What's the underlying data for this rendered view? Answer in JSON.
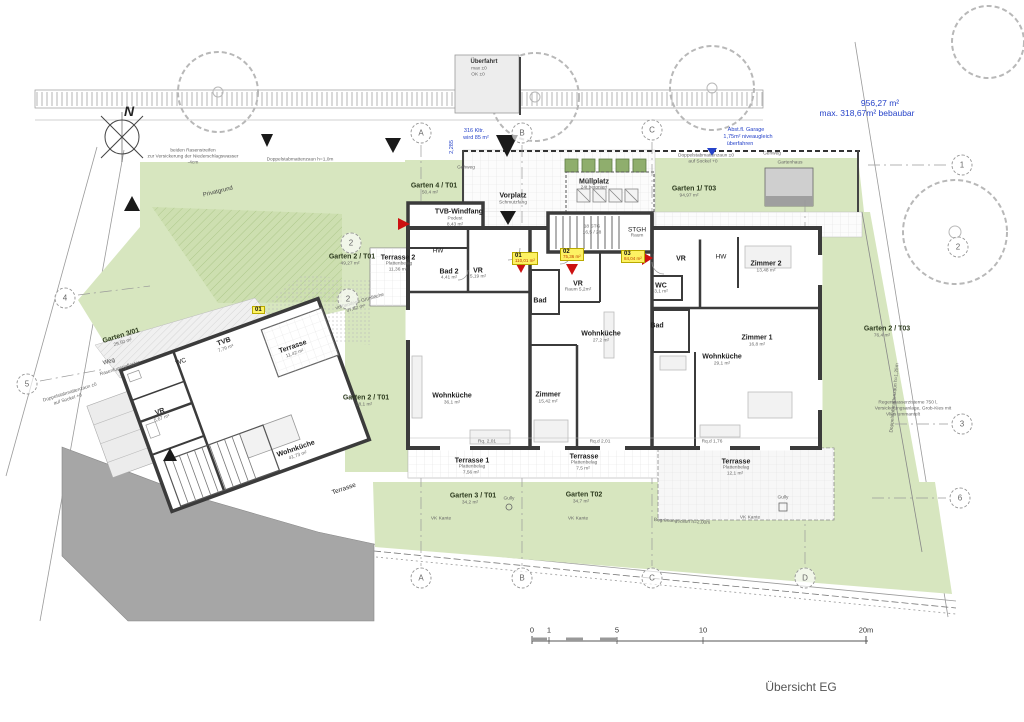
{
  "title": {
    "text": "Übersicht EG"
  },
  "colors": {
    "garden_green": "#d7e6bf",
    "hatch_green": "#aec88b",
    "street_gray": "#a6a6a6",
    "wall_dark": "#3b3b3b",
    "annotation_blue": "#2643c9",
    "unit_badge_yellow": "#fdf263",
    "entrance_red": "#cc1111"
  },
  "scalebar": {
    "unit": "m",
    "ticks": [
      {
        "t": "0",
        "x": 532
      },
      {
        "t": "1",
        "x": 549
      },
      {
        "t": "5",
        "x": 617
      },
      {
        "t": "10",
        "x": 703
      },
      {
        "t": "20m",
        "x": 866
      }
    ]
  },
  "badges": [
    {
      "no": "01",
      "area": "110,01 m²",
      "x": 512,
      "y": 252
    },
    {
      "no": "02",
      "area": "75,36 m²",
      "x": 560,
      "y": 248
    },
    {
      "no": "03",
      "area": "84,04 m²",
      "x": 621,
      "y": 250
    },
    {
      "no": "01",
      "area": "",
      "x": 252,
      "y": 306
    }
  ],
  "bubbles": [
    {
      "t": "A",
      "x": 421,
      "y": 133
    },
    {
      "t": "B",
      "x": 522,
      "y": 133
    },
    {
      "t": "C",
      "x": 652,
      "y": 130
    },
    {
      "t": "1",
      "x": 962,
      "y": 165
    },
    {
      "t": "2",
      "x": 958,
      "y": 247
    },
    {
      "t": "3",
      "x": 962,
      "y": 424
    },
    {
      "t": "6",
      "x": 960,
      "y": 498
    },
    {
      "t": "4",
      "x": 65,
      "y": 298
    },
    {
      "t": "5",
      "x": 27,
      "y": 384
    },
    {
      "t": "A",
      "x": 421,
      "y": 578
    },
    {
      "t": "B",
      "x": 522,
      "y": 578
    },
    {
      "t": "C",
      "x": 652,
      "y": 578
    },
    {
      "t": "D",
      "x": 805,
      "y": 578
    },
    {
      "t": "2",
      "x": 351,
      "y": 243
    },
    {
      "t": "2",
      "x": 348,
      "y": 299
    }
  ],
  "labels": [
    {
      "t": "N",
      "x": 129,
      "y": 111,
      "c": "north"
    },
    {
      "t": "956,27 m²",
      "x": 880,
      "y": 103,
      "c": "bn"
    },
    {
      "t": "max. 318,67m² bebaubar",
      "x": 867,
      "y": 113,
      "c": "bn"
    },
    {
      "t": "Überfahrt",
      "x": 484,
      "y": 62,
      "c": "tb"
    },
    {
      "t": "max ±0",
      "x": 479,
      "y": 69,
      "c": "m"
    },
    {
      "t": "OK ±0",
      "x": 478,
      "y": 75,
      "c": "m"
    },
    {
      "t": "316 Kltr.",
      "x": 474,
      "y": 131,
      "c": "bt"
    },
    {
      "t": "wird 85 m²",
      "x": 476,
      "y": 138,
      "c": "bt"
    },
    {
      "t": "2,285",
      "x": 452,
      "y": 147,
      "c": "bt",
      "r": -90
    },
    {
      "t": "Abst.fl. Garage",
      "x": 746,
      "y": 130,
      "c": "bt"
    },
    {
      "t": "1,75m² niveaugleich",
      "x": 748,
      "y": 137,
      "c": "bt"
    },
    {
      "t": "überfahren",
      "x": 740,
      "y": 144,
      "c": "bt"
    },
    {
      "t": "beiden Rasenstreifen",
      "x": 193,
      "y": 151,
      "c": "m"
    },
    {
      "t": "zur Versickerung der Niederschlagswasser",
      "x": 193,
      "y": 157,
      "c": "m"
    },
    {
      "t": "-4cm",
      "x": 193,
      "y": 163,
      "c": "m"
    },
    {
      "t": "Privatgrund",
      "x": 218,
      "y": 192,
      "c": "t",
      "r": -14
    },
    {
      "t": "Doppelstabmattenzaun h=1,0m",
      "x": 300,
      "y": 160,
      "c": "m"
    },
    {
      "t": "Gehweg",
      "x": 466,
      "y": 168,
      "c": "m"
    },
    {
      "t": "Garten 4 / T01",
      "x": 434,
      "y": 186,
      "c": "g"
    },
    {
      "t": "50,4 m²",
      "x": 430,
      "y": 193,
      "c": "m"
    },
    {
      "t": "Vorplatz",
      "x": 513,
      "y": 196,
      "c": "rb"
    },
    {
      "t": "Schmutzfang",
      "x": 513,
      "y": 203,
      "c": "m"
    },
    {
      "t": "Müllplatz",
      "x": 594,
      "y": 182,
      "c": "rb"
    },
    {
      "t": "24t betoniert",
      "x": 594,
      "y": 188,
      "c": "m"
    },
    {
      "t": "Gehweg",
      "x": 772,
      "y": 154,
      "c": "m"
    },
    {
      "t": "Doppelstabmattenzaun ±0",
      "x": 706,
      "y": 156,
      "c": "m"
    },
    {
      "t": "auf Sockel +0",
      "x": 703,
      "y": 162,
      "c": "m"
    },
    {
      "t": "Garten 1/ T03",
      "x": 694,
      "y": 189,
      "c": "g"
    },
    {
      "t": "94,97 m²",
      "x": 689,
      "y": 196,
      "c": "m"
    },
    {
      "t": "Gartenhaus",
      "x": 790,
      "y": 163,
      "c": "m"
    },
    {
      "t": "TVB-Windfang",
      "x": 459,
      "y": 212,
      "c": "rb"
    },
    {
      "t": "Podest",
      "x": 455,
      "y": 219,
      "c": "m"
    },
    {
      "t": "8,43 m²",
      "x": 455,
      "y": 225,
      "c": "m"
    },
    {
      "t": "Terrasse 2",
      "x": 398,
      "y": 258,
      "c": "rb"
    },
    {
      "t": "Plattenbelag",
      "x": 399,
      "y": 264,
      "c": "m"
    },
    {
      "t": "11,36 m²",
      "x": 398,
      "y": 270,
      "c": "m"
    },
    {
      "t": "Garten 2 / T01",
      "x": 352,
      "y": 257,
      "c": "g"
    },
    {
      "t": "49,27 m²",
      "x": 350,
      "y": 264,
      "c": "m"
    },
    {
      "t": "vorhandene Grünfläche",
      "x": 360,
      "y": 302,
      "c": "m",
      "r": -16
    },
    {
      "t": "57,82 m²",
      "x": 356,
      "y": 309,
      "c": "m",
      "r": -16
    },
    {
      "t": "Garten 2 / T01",
      "x": 366,
      "y": 398,
      "c": "g"
    },
    {
      "t": "38,1 m²",
      "x": 364,
      "y": 405,
      "c": "m"
    },
    {
      "t": "HW",
      "x": 438,
      "y": 251,
      "c": "r"
    },
    {
      "t": "Bad 2",
      "x": 449,
      "y": 272,
      "c": "rb"
    },
    {
      "t": "4,41 m²",
      "x": 449,
      "y": 278,
      "c": "m"
    },
    {
      "t": "VR",
      "x": 478,
      "y": 271,
      "c": "rb"
    },
    {
      "t": "5,19 m²",
      "x": 478,
      "y": 277,
      "c": "m"
    },
    {
      "t": "18 STG",
      "x": 592,
      "y": 227,
      "c": "m"
    },
    {
      "t": "16,5 / 28",
      "x": 592,
      "y": 233,
      "c": "m"
    },
    {
      "t": "STGH",
      "x": 637,
      "y": 230,
      "c": "r"
    },
    {
      "t": "Raum",
      "x": 637,
      "y": 236,
      "c": "m"
    },
    {
      "t": "Bad",
      "x": 540,
      "y": 301,
      "c": "rb"
    },
    {
      "t": "VR",
      "x": 578,
      "y": 284,
      "c": "rb"
    },
    {
      "t": "Raum 5,2m²",
      "x": 578,
      "y": 290,
      "c": "m"
    },
    {
      "t": "WC",
      "x": 661,
      "y": 286,
      "c": "rb"
    },
    {
      "t": "3,1 m²",
      "x": 661,
      "y": 292,
      "c": "m"
    },
    {
      "t": "VR",
      "x": 681,
      "y": 259,
      "c": "rb"
    },
    {
      "t": "HW",
      "x": 721,
      "y": 257,
      "c": "r"
    },
    {
      "t": "Zimmer 2",
      "x": 766,
      "y": 264,
      "c": "rb"
    },
    {
      "t": "13,48 m²",
      "x": 766,
      "y": 271,
      "c": "m"
    },
    {
      "t": "Bad",
      "x": 657,
      "y": 326,
      "c": "rb"
    },
    {
      "t": "Wohnküche",
      "x": 601,
      "y": 334,
      "c": "rb"
    },
    {
      "t": "27,2 m²",
      "x": 601,
      "y": 341,
      "c": "m"
    },
    {
      "t": "Zimmer",
      "x": 548,
      "y": 395,
      "c": "rb"
    },
    {
      "t": "15,42 m²",
      "x": 548,
      "y": 402,
      "c": "m"
    },
    {
      "t": "Wohnküche",
      "x": 452,
      "y": 396,
      "c": "rb"
    },
    {
      "t": "36,1 m²",
      "x": 452,
      "y": 403,
      "c": "m"
    },
    {
      "t": "Zimmer 1",
      "x": 757,
      "y": 338,
      "c": "rb"
    },
    {
      "t": "16,8 m²",
      "x": 757,
      "y": 345,
      "c": "m"
    },
    {
      "t": "Wohnküche",
      "x": 722,
      "y": 357,
      "c": "rb"
    },
    {
      "t": "29,1 m²",
      "x": 722,
      "y": 364,
      "c": "m"
    },
    {
      "t": "Rq. 2,01",
      "x": 487,
      "y": 442,
      "c": "m"
    },
    {
      "t": "Rq.d 2,01",
      "x": 600,
      "y": 442,
      "c": "m"
    },
    {
      "t": "Rq.d 1,76",
      "x": 712,
      "y": 442,
      "c": "m"
    },
    {
      "t": "Terrasse 1",
      "x": 472,
      "y": 461,
      "c": "rb"
    },
    {
      "t": "Plattenbelag",
      "x": 472,
      "y": 467,
      "c": "m"
    },
    {
      "t": "7,56 m²",
      "x": 471,
      "y": 473,
      "c": "m"
    },
    {
      "t": "Terrasse",
      "x": 584,
      "y": 457,
      "c": "rb"
    },
    {
      "t": "Plattenbelag",
      "x": 584,
      "y": 463,
      "c": "m"
    },
    {
      "t": "7,5 m²",
      "x": 583,
      "y": 469,
      "c": "m"
    },
    {
      "t": "Terrasse",
      "x": 736,
      "y": 462,
      "c": "rb"
    },
    {
      "t": "Plattenbelag",
      "x": 736,
      "y": 468,
      "c": "m"
    },
    {
      "t": "12,1 m²",
      "x": 735,
      "y": 474,
      "c": "m"
    },
    {
      "t": "Garten 3 / T01",
      "x": 473,
      "y": 496,
      "c": "g"
    },
    {
      "t": "34,2 m²",
      "x": 470,
      "y": 503,
      "c": "m"
    },
    {
      "t": "Gully",
      "x": 509,
      "y": 499,
      "c": "m"
    },
    {
      "t": "Garten T02",
      "x": 584,
      "y": 495,
      "c": "g"
    },
    {
      "t": "34,7 m²",
      "x": 581,
      "y": 502,
      "c": "m"
    },
    {
      "t": "Gully",
      "x": 783,
      "y": 498,
      "c": "m"
    },
    {
      "t": "VK Kante",
      "x": 441,
      "y": 519,
      "c": "m"
    },
    {
      "t": "VK Kante",
      "x": 578,
      "y": 519,
      "c": "m"
    },
    {
      "t": "VK Kante",
      "x": 750,
      "y": 518,
      "c": "m"
    },
    {
      "t": "Garten 2 / T03",
      "x": 887,
      "y": 329,
      "c": "g"
    },
    {
      "t": "76,4 m²",
      "x": 882,
      "y": 336,
      "c": "m"
    },
    {
      "t": "Doppelstabmattenzaun h=1,25m",
      "x": 895,
      "y": 398,
      "c": "m",
      "r": -85
    },
    {
      "t": "Regenwasserzisterne 750 l,",
      "x": 908,
      "y": 403,
      "c": "m"
    },
    {
      "t": "Versickerungsanlage, Grob-Kies mit",
      "x": 913,
      "y": 409,
      "c": "m"
    },
    {
      "t": "Vlies ummantelt",
      "x": 903,
      "y": 415,
      "c": "m"
    },
    {
      "t": "Begrünungszaun h=2,00m",
      "x": 682,
      "y": 522,
      "c": "m",
      "r": 3
    },
    {
      "t": "TVB",
      "x": 224,
      "y": 342,
      "c": "rb",
      "r": -19
    },
    {
      "t": "7,79 m²",
      "x": 226,
      "y": 349,
      "c": "m",
      "r": -19
    },
    {
      "t": "Terrasse",
      "x": 293,
      "y": 347,
      "c": "rb",
      "r": -19
    },
    {
      "t": "11,42 m²",
      "x": 295,
      "y": 354,
      "c": "m",
      "r": -19
    },
    {
      "t": "WC",
      "x": 181,
      "y": 362,
      "c": "r",
      "r": -19
    },
    {
      "t": "VR",
      "x": 160,
      "y": 412,
      "c": "rb",
      "r": -19
    },
    {
      "t": "5,67 m²",
      "x": 162,
      "y": 419,
      "c": "m",
      "r": -19
    },
    {
      "t": "Wohnküche",
      "x": 296,
      "y": 449,
      "c": "rb",
      "r": -19
    },
    {
      "t": "41,73 m²",
      "x": 298,
      "y": 456,
      "c": "m",
      "r": -19
    },
    {
      "t": "Terrasse",
      "x": 344,
      "y": 489,
      "c": "r",
      "r": -19
    },
    {
      "t": "Garten 3/01",
      "x": 121,
      "y": 336,
      "c": "g",
      "r": -17
    },
    {
      "t": "29,50 m²",
      "x": 123,
      "y": 343,
      "c": "m",
      "r": -17
    },
    {
      "t": "Weg",
      "x": 109,
      "y": 362,
      "c": "t",
      "r": -17
    },
    {
      "t": "Rasenfugenpflaster",
      "x": 120,
      "y": 369,
      "c": "m",
      "r": -17
    },
    {
      "t": "Doppelstabmattenzaun ±0",
      "x": 70,
      "y": 393,
      "c": "m",
      "r": -17
    },
    {
      "t": "auf Sockel +0",
      "x": 68,
      "y": 400,
      "c": "m",
      "r": -17
    }
  ]
}
